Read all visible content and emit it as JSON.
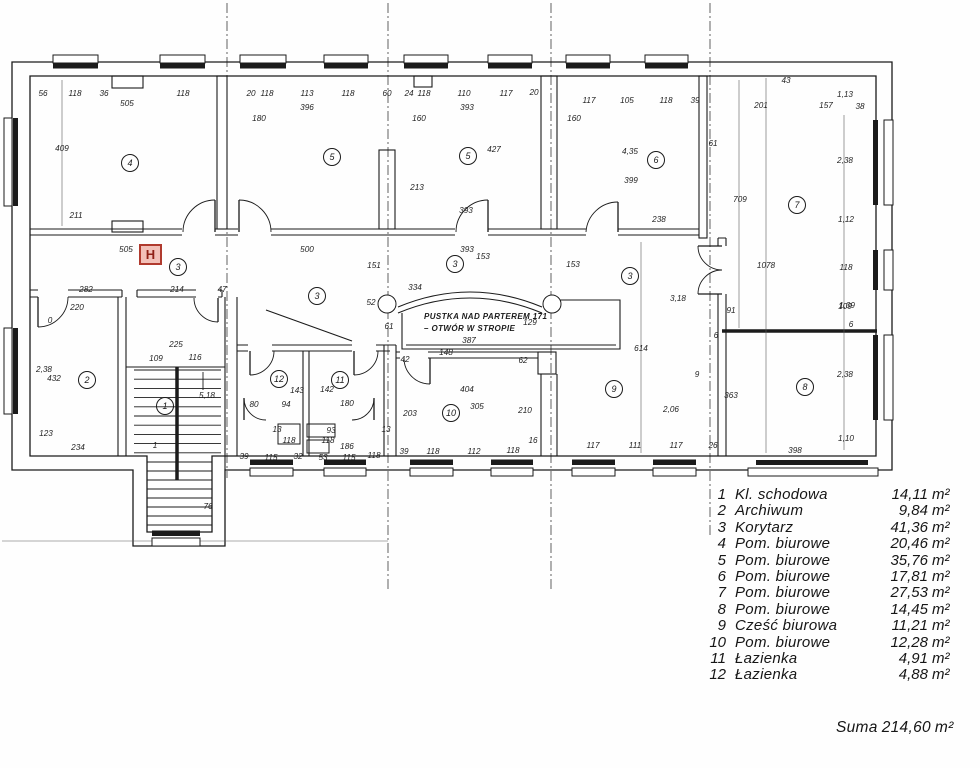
{
  "colors": {
    "ink": "#1b1b1b",
    "paper": "#fefefe",
    "hydrant_red": "#b03a2e",
    "hydrant_fill": "#f2c0b8",
    "hydrant_letter": "#8e1f15"
  },
  "plan": {
    "hydrant": {
      "label": "H"
    },
    "void_note": {
      "line1": "PUSTKA NAD PARTEREM 171",
      "line2": "–  OTWÓR W STROPIE"
    },
    "room_markers": [
      {
        "no": "4",
        "x": 130,
        "y": 163
      },
      {
        "no": "5",
        "x": 332,
        "y": 157
      },
      {
        "no": "5",
        "x": 468,
        "y": 156
      },
      {
        "no": "6",
        "x": 656,
        "y": 160
      },
      {
        "no": "7",
        "x": 797,
        "y": 205
      },
      {
        "no": "8",
        "x": 805,
        "y": 387
      },
      {
        "no": "9",
        "x": 614,
        "y": 389
      },
      {
        "no": "10",
        "x": 451,
        "y": 413
      },
      {
        "no": "11",
        "x": 340,
        "y": 380
      },
      {
        "no": "12",
        "x": 279,
        "y": 379
      },
      {
        "no": "1",
        "x": 165,
        "y": 406
      },
      {
        "no": "2",
        "x": 87,
        "y": 380
      },
      {
        "no": "3",
        "x": 178,
        "y": 267
      },
      {
        "no": "3",
        "x": 317,
        "y": 296
      },
      {
        "no": "3",
        "x": 455,
        "y": 264
      },
      {
        "no": "3",
        "x": 630,
        "y": 276
      }
    ],
    "dim_labels": [
      {
        "t": "56",
        "x": 43,
        "y": 96
      },
      {
        "t": "118",
        "x": 75,
        "y": 96
      },
      {
        "t": "36",
        "x": 104,
        "y": 96
      },
      {
        "t": "505",
        "x": 127,
        "y": 106
      },
      {
        "t": "118",
        "x": 183,
        "y": 96
      },
      {
        "t": "20",
        "x": 251,
        "y": 96
      },
      {
        "t": "118",
        "x": 267,
        "y": 96
      },
      {
        "t": "113",
        "x": 307,
        "y": 96
      },
      {
        "t": "118",
        "x": 348,
        "y": 96
      },
      {
        "t": "396",
        "x": 307,
        "y": 110
      },
      {
        "t": "60",
        "x": 387,
        "y": 96
      },
      {
        "t": "180",
        "x": 259,
        "y": 121
      },
      {
        "t": "24",
        "x": 409,
        "y": 96
      },
      {
        "t": "118",
        "x": 424,
        "y": 96
      },
      {
        "t": "110",
        "x": 464,
        "y": 96
      },
      {
        "t": "117",
        "x": 506,
        "y": 96
      },
      {
        "t": "20",
        "x": 534,
        "y": 95
      },
      {
        "t": "393",
        "x": 467,
        "y": 110
      },
      {
        "t": "160",
        "x": 419,
        "y": 121
      },
      {
        "t": "117",
        "x": 589,
        "y": 103
      },
      {
        "t": "105",
        "x": 627,
        "y": 103
      },
      {
        "t": "118",
        "x": 666,
        "y": 103
      },
      {
        "t": "39",
        "x": 695,
        "y": 103
      },
      {
        "t": "160",
        "x": 574,
        "y": 121
      },
      {
        "t": "43",
        "x": 786,
        "y": 83
      },
      {
        "t": "1,13",
        "x": 845,
        "y": 97
      },
      {
        "t": "201",
        "x": 761,
        "y": 108
      },
      {
        "t": "157",
        "x": 826,
        "y": 108
      },
      {
        "t": "38",
        "x": 860,
        "y": 109
      },
      {
        "t": "409",
        "x": 62,
        "y": 151
      },
      {
        "t": "427",
        "x": 494,
        "y": 152
      },
      {
        "t": "4,35",
        "x": 630,
        "y": 154
      },
      {
        "t": "61",
        "x": 713,
        "y": 146
      },
      {
        "t": "213",
        "x": 417,
        "y": 190
      },
      {
        "t": "399",
        "x": 631,
        "y": 183
      },
      {
        "t": "709",
        "x": 740,
        "y": 202
      },
      {
        "t": "1078",
        "x": 766,
        "y": 268
      },
      {
        "t": "211",
        "x": 76,
        "y": 218
      },
      {
        "t": "393",
        "x": 466,
        "y": 213
      },
      {
        "t": "238",
        "x": 659,
        "y": 222
      },
      {
        "t": "2,38",
        "x": 845,
        "y": 163
      },
      {
        "t": "1,12",
        "x": 846,
        "y": 222
      },
      {
        "t": "118",
        "x": 846,
        "y": 270
      },
      {
        "t": "1,09",
        "x": 847,
        "y": 308
      },
      {
        "t": "6",
        "x": 851,
        "y": 327
      },
      {
        "t": "505",
        "x": 126,
        "y": 252
      },
      {
        "t": "500",
        "x": 307,
        "y": 252
      },
      {
        "t": "393",
        "x": 467,
        "y": 252
      },
      {
        "t": "153",
        "x": 483,
        "y": 259
      },
      {
        "t": "153",
        "x": 573,
        "y": 267
      },
      {
        "t": "151",
        "x": 374,
        "y": 268
      },
      {
        "t": "52",
        "x": 371,
        "y": 305
      },
      {
        "t": "334",
        "x": 415,
        "y": 290
      },
      {
        "t": "61",
        "x": 389,
        "y": 329
      },
      {
        "t": "129",
        "x": 530,
        "y": 325
      },
      {
        "t": "387",
        "x": 469,
        "y": 343
      },
      {
        "t": "282",
        "x": 86,
        "y": 292
      },
      {
        "t": "214",
        "x": 177,
        "y": 292
      },
      {
        "t": "47",
        "x": 222,
        "y": 292
      },
      {
        "t": "220",
        "x": 77,
        "y": 310
      },
      {
        "t": "0",
        "x": 50,
        "y": 323
      },
      {
        "t": "2,38",
        "x": 44,
        "y": 372
      },
      {
        "t": "432",
        "x": 54,
        "y": 381
      },
      {
        "t": "123",
        "x": 46,
        "y": 436
      },
      {
        "t": "234",
        "x": 78,
        "y": 450
      },
      {
        "t": "225",
        "x": 176,
        "y": 347
      },
      {
        "t": "109",
        "x": 156,
        "y": 361
      },
      {
        "t": "116",
        "x": 195,
        "y": 360
      },
      {
        "t": "5,18",
        "x": 207,
        "y": 398
      },
      {
        "t": "1",
        "x": 155,
        "y": 448
      },
      {
        "t": "76",
        "x": 208,
        "y": 509
      },
      {
        "t": "143",
        "x": 297,
        "y": 393
      },
      {
        "t": "142",
        "x": 327,
        "y": 392
      },
      {
        "t": "80",
        "x": 254,
        "y": 407
      },
      {
        "t": "94",
        "x": 286,
        "y": 407
      },
      {
        "t": "180",
        "x": 347,
        "y": 406
      },
      {
        "t": "13",
        "x": 277,
        "y": 432
      },
      {
        "t": "93",
        "x": 331,
        "y": 433
      },
      {
        "t": "13",
        "x": 386,
        "y": 432
      },
      {
        "t": "118",
        "x": 289,
        "y": 443
      },
      {
        "t": "118",
        "x": 328,
        "y": 443
      },
      {
        "t": "186",
        "x": 347,
        "y": 449
      },
      {
        "t": "39",
        "x": 244,
        "y": 459
      },
      {
        "t": "115",
        "x": 271,
        "y": 460
      },
      {
        "t": "32",
        "x": 298,
        "y": 459
      },
      {
        "t": "53",
        "x": 323,
        "y": 460
      },
      {
        "t": "115",
        "x": 349,
        "y": 460
      },
      {
        "t": "118",
        "x": 374,
        "y": 458
      },
      {
        "t": "42",
        "x": 405,
        "y": 362
      },
      {
        "t": "148",
        "x": 446,
        "y": 355
      },
      {
        "t": "62",
        "x": 523,
        "y": 363
      },
      {
        "t": "404",
        "x": 467,
        "y": 392
      },
      {
        "t": "305",
        "x": 477,
        "y": 409
      },
      {
        "t": "210",
        "x": 525,
        "y": 413
      },
      {
        "t": "203",
        "x": 410,
        "y": 416
      },
      {
        "t": "16",
        "x": 533,
        "y": 443
      },
      {
        "t": "39",
        "x": 404,
        "y": 454
      },
      {
        "t": "118",
        "x": 433,
        "y": 454
      },
      {
        "t": "112",
        "x": 474,
        "y": 454
      },
      {
        "t": "118",
        "x": 513,
        "y": 453
      },
      {
        "t": "614",
        "x": 641,
        "y": 351
      },
      {
        "t": "117",
        "x": 593,
        "y": 448
      },
      {
        "t": "111",
        "x": 635,
        "y": 448
      },
      {
        "t": "117",
        "x": 676,
        "y": 448
      },
      {
        "t": "26",
        "x": 713,
        "y": 448
      },
      {
        "t": "3,18",
        "x": 678,
        "y": 301
      },
      {
        "t": "9",
        "x": 697,
        "y": 377
      },
      {
        "t": "91",
        "x": 731,
        "y": 313
      },
      {
        "t": "6",
        "x": 716,
        "y": 338
      },
      {
        "t": "363",
        "x": 731,
        "y": 398
      },
      {
        "t": "2,06",
        "x": 671,
        "y": 412
      },
      {
        "t": "398",
        "x": 795,
        "y": 453
      },
      {
        "t": "2,38",
        "x": 845,
        "y": 377
      },
      {
        "t": "1,10",
        "x": 846,
        "y": 441
      },
      {
        "t": "109",
        "x": 845,
        "y": 309
      }
    ]
  },
  "legend": {
    "items": [
      {
        "no": "1",
        "name": "Kl. schodowa",
        "area": "14,11"
      },
      {
        "no": "2",
        "name": "Archiwum",
        "area": "9,84"
      },
      {
        "no": "3",
        "name": "Korytarz",
        "area": "41,36"
      },
      {
        "no": "4",
        "name": "Pom. biurowe",
        "area": "20,46"
      },
      {
        "no": "5",
        "name": "Pom. biurowe",
        "area": "35,76"
      },
      {
        "no": "6",
        "name": "Pom. biurowe",
        "area": "17,81"
      },
      {
        "no": "7",
        "name": "Pom. biurowe",
        "area": "27,53"
      },
      {
        "no": "8",
        "name": "Pom. biurowe",
        "area": "14,45"
      },
      {
        "no": "9",
        "name": "Cześć biurowa",
        "area": "11,21"
      },
      {
        "no": "10",
        "name": "Pom. biurowe",
        "area": "12,28"
      },
      {
        "no": "11",
        "name": "Łazienka",
        "area": "4,91"
      },
      {
        "no": "12",
        "name": "Łazienka",
        "area": "4,88"
      }
    ],
    "unit": "m²",
    "suma_label": "Suma",
    "suma_value": "214,60"
  }
}
